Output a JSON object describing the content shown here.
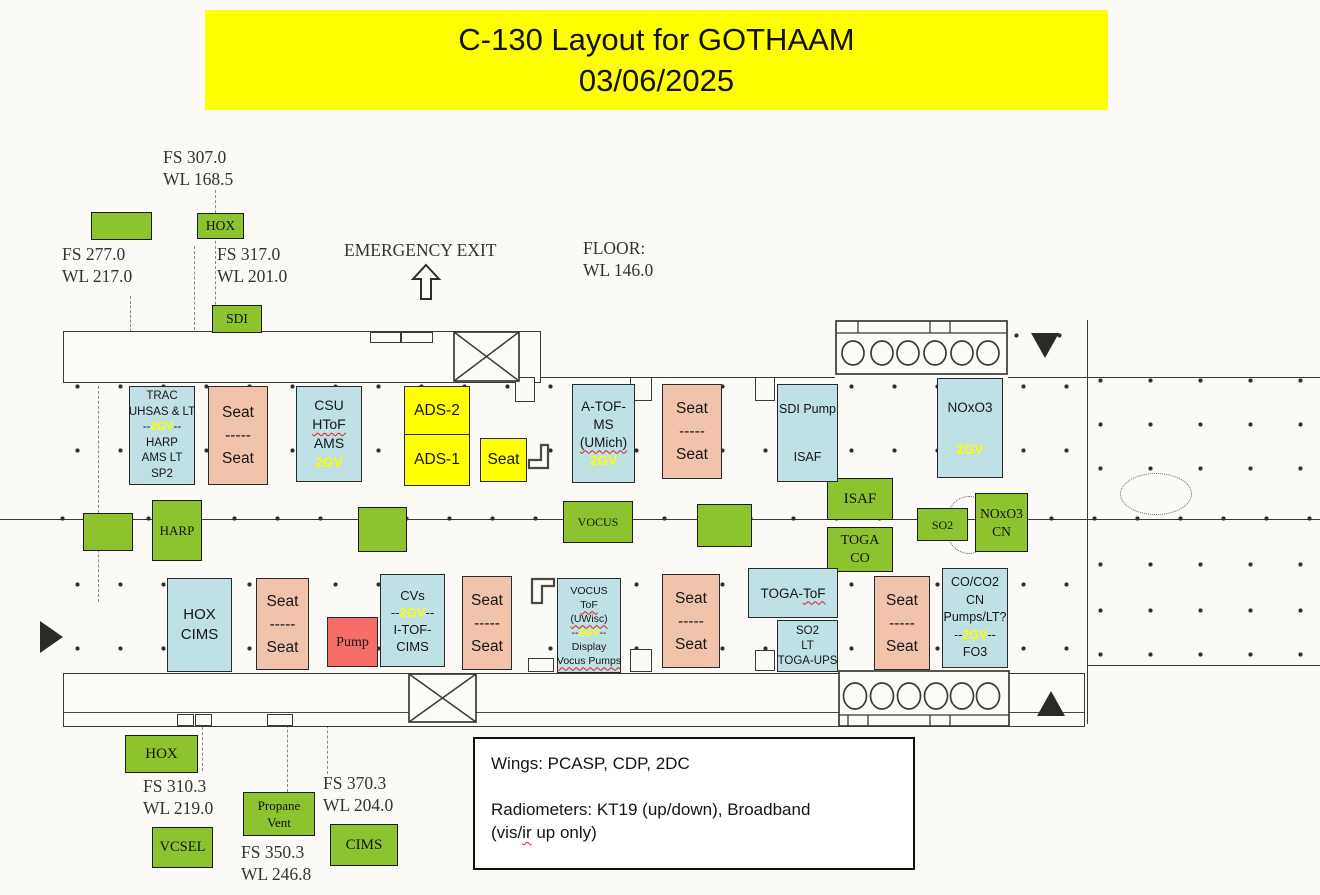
{
  "title": {
    "line1": "C-130 Layout for GOTHAAM",
    "line2": "03/06/2025"
  },
  "colors": {
    "banner_bg": "#ffff00",
    "green": "#8dc32e",
    "blue": "#bfe0e4",
    "salmon": "#f2c3ab",
    "yellow": "#ffff00",
    "red": "#f56d66",
    "accent_2gv": "#ffff00",
    "wavy_underline": "#e01b1b"
  },
  "station_labels": [
    {
      "name": "fs-307-label",
      "x": 163,
      "y": 146,
      "lines": [
        "FS 307.0",
        "WL 168.5"
      ]
    },
    {
      "name": "fs-277-label",
      "x": 62,
      "y": 243,
      "lines": [
        "FS 277.0",
        "WL 217.0"
      ]
    },
    {
      "name": "fs-317-label",
      "x": 217,
      "y": 243,
      "lines": [
        "FS 317.0",
        "WL 201.0"
      ]
    },
    {
      "name": "emergency-exit-label",
      "x": 344,
      "y": 239,
      "lines": [
        "EMERGENCY EXIT"
      ]
    },
    {
      "name": "floor-label",
      "x": 583,
      "y": 237,
      "lines": [
        "FLOOR:",
        "WL 146.0"
      ]
    },
    {
      "name": "fs-310-label",
      "x": 143,
      "y": 775,
      "lines": [
        "FS 310.3",
        "WL 219.0"
      ]
    },
    {
      "name": "fs-370-label",
      "x": 323,
      "y": 772,
      "lines": [
        "FS 370.3",
        "WL 204.0"
      ]
    },
    {
      "name": "fs-350-label",
      "x": 241,
      "y": 841,
      "lines": [
        "FS 350.3",
        "WL 246.8"
      ]
    }
  ],
  "green_boxes": [
    {
      "name": "green-box-unlabeled-top",
      "x": 91,
      "y": 212,
      "w": 61,
      "h": 28,
      "fs": 13,
      "lines": []
    },
    {
      "name": "hox-top-box",
      "x": 197,
      "y": 213,
      "w": 47,
      "h": 26,
      "fs": 13.5,
      "lines": [
        "HOX"
      ]
    },
    {
      "name": "sdi-box",
      "x": 212,
      "y": 305,
      "w": 50,
      "h": 28,
      "fs": 13.5,
      "lines": [
        "SDI"
      ]
    },
    {
      "name": "green-box-unlabeled-mid-left",
      "x": 83,
      "y": 513,
      "w": 50,
      "h": 38,
      "fs": 13,
      "lines": []
    },
    {
      "name": "harp-box",
      "x": 152,
      "y": 500,
      "w": 50,
      "h": 61,
      "fs": 13,
      "lines": [
        "HARP"
      ]
    },
    {
      "name": "green-box-unlabeled-mid-center",
      "x": 358,
      "y": 507,
      "w": 49,
      "h": 45,
      "fs": 13,
      "lines": []
    },
    {
      "name": "vocus-box",
      "x": 563,
      "y": 501,
      "w": 70,
      "h": 42,
      "fs": 12,
      "lines": [
        "VOCUS"
      ]
    },
    {
      "name": "green-box-unlabeled-mid-right",
      "x": 697,
      "y": 504,
      "w": 55,
      "h": 43,
      "fs": 13,
      "lines": []
    },
    {
      "name": "isaf-box",
      "x": 827,
      "y": 478,
      "w": 66,
      "h": 42,
      "fs": 15,
      "lines": [
        "ISAF"
      ]
    },
    {
      "name": "toga-co-box",
      "x": 827,
      "y": 527,
      "w": 66,
      "h": 45,
      "fs": 14,
      "lines": [
        "TOGA",
        "CO"
      ]
    },
    {
      "name": "so2-box",
      "x": 917,
      "y": 508,
      "w": 51,
      "h": 33,
      "fs": 12,
      "lines": [
        "SO2"
      ]
    },
    {
      "name": "noxo3-cn-box",
      "x": 975,
      "y": 493,
      "w": 53,
      "h": 59,
      "fs": 13.5,
      "lines": [
        "NOxO3",
        "CN"
      ]
    },
    {
      "name": "hox-bottom-box",
      "x": 125,
      "y": 735,
      "w": 73,
      "h": 38,
      "fs": 15,
      "lines": [
        "HOX"
      ]
    },
    {
      "name": "propane-vent-box",
      "x": 243,
      "y": 792,
      "w": 72,
      "h": 44,
      "fs": 13,
      "lines": [
        "Propane",
        "Vent"
      ]
    },
    {
      "name": "vcsel-box",
      "x": 152,
      "y": 827,
      "w": 61,
      "h": 41,
      "fs": 14.5,
      "lines": [
        "VCSEL"
      ]
    },
    {
      "name": "cims-box",
      "x": 330,
      "y": 824,
      "w": 68,
      "h": 42,
      "fs": 15,
      "lines": [
        "CIMS"
      ]
    }
  ],
  "instruments": [
    {
      "name": "trac-uhsas-rack",
      "type": "blue",
      "x": 129,
      "y": 386,
      "w": 66,
      "h": 99,
      "fs": 11.5,
      "lh": 15.5,
      "lines": [
        [
          {
            "t": "TRAC"
          }
        ],
        [
          {
            "t": "UHSAS & LT"
          }
        ],
        [
          {
            "t": "--"
          },
          {
            "t": "2GV",
            "y": 1
          },
          {
            "t": "--"
          }
        ],
        [
          {
            "t": "HARP"
          }
        ],
        [
          {
            "t": "AMS LT"
          }
        ],
        [
          {
            "t": "SP2"
          }
        ]
      ]
    },
    {
      "name": "seat-rack-1",
      "type": "salmon",
      "x": 208,
      "y": 386,
      "w": 60,
      "h": 99,
      "fs": 15.5,
      "lh": 23,
      "lines": [
        [
          {
            "t": "Seat"
          }
        ],
        [
          {
            "t": "-----"
          }
        ],
        [
          {
            "t": "Seat"
          }
        ]
      ]
    },
    {
      "name": "csu-htof-ams-rack",
      "type": "blue",
      "x": 296,
      "y": 386,
      "w": 66,
      "h": 96,
      "fs": 14,
      "lh": 19,
      "lines": [
        [
          {
            "t": "CSU"
          }
        ],
        [
          {
            "t": "HToF",
            "w": 1
          }
        ],
        [
          {
            "t": "AMS"
          }
        ],
        [
          {
            "t": "2GV",
            "y": 1
          }
        ]
      ]
    },
    {
      "name": "ads-2-box",
      "type": "yellow",
      "x": 404,
      "y": 386,
      "w": 66,
      "h": 49,
      "fs": 15.5,
      "lh": 18,
      "lines": [
        [
          {
            "t": "ADS-2"
          }
        ]
      ]
    },
    {
      "name": "ads-1-box",
      "type": "yellow",
      "x": 404,
      "y": 434,
      "w": 66,
      "h": 52,
      "fs": 15.5,
      "lh": 18,
      "lines": [
        [
          {
            "t": "ADS-1"
          }
        ]
      ]
    },
    {
      "name": "seat-yellow-box",
      "type": "yellow",
      "x": 480,
      "y": 438,
      "w": 47,
      "h": 44,
      "fs": 15.5,
      "lh": 18,
      "lines": [
        [
          {
            "t": "Seat"
          }
        ]
      ]
    },
    {
      "name": "a-tof-ms-rack",
      "type": "blue",
      "x": 572,
      "y": 384,
      "w": 63,
      "h": 99,
      "fs": 13.5,
      "lh": 18,
      "lines": [
        [
          {
            "t": "A-TOF-"
          }
        ],
        [
          {
            "t": "MS"
          }
        ],
        [
          {
            "t": "(UMich)",
            "w": 1
          }
        ],
        [
          {
            "t": "2GV",
            "y": 1
          }
        ]
      ]
    },
    {
      "name": "seat-rack-2",
      "type": "salmon",
      "x": 662,
      "y": 384,
      "w": 60,
      "h": 95,
      "fs": 15.5,
      "lh": 23,
      "lines": [
        [
          {
            "t": "Seat"
          }
        ],
        [
          {
            "t": "-----"
          }
        ],
        [
          {
            "t": "Seat"
          }
        ]
      ]
    },
    {
      "name": "sdi-pump-isaf-rack",
      "type": "blue",
      "x": 777,
      "y": 384,
      "w": 61,
      "h": 98,
      "fs": 12.5,
      "lh": 16,
      "lines": [
        [
          {
            "t": "SDI Pump"
          }
        ],
        [],
        [],
        [
          {
            "t": "ISAF"
          }
        ]
      ]
    },
    {
      "name": "noxo3-rack",
      "type": "blue",
      "x": 937,
      "y": 378,
      "w": 66,
      "h": 100,
      "fs": 13.5,
      "lh": 21,
      "lines": [
        [
          {
            "t": "NOxO3"
          }
        ],
        [],
        [
          {
            "t": "2GV",
            "y": 1
          }
        ]
      ]
    },
    {
      "name": "hox-cims-rack",
      "type": "blue",
      "x": 167,
      "y": 578,
      "w": 65,
      "h": 94,
      "fs": 15,
      "lh": 20,
      "lines": [
        [
          {
            "t": "HOX"
          }
        ],
        [
          {
            "t": "CIMS"
          }
        ]
      ]
    },
    {
      "name": "seat-rack-3",
      "type": "salmon",
      "x": 256,
      "y": 578,
      "w": 53,
      "h": 92,
      "fs": 15.5,
      "lh": 23,
      "lines": [
        [
          {
            "t": "Seat"
          }
        ],
        [
          {
            "t": "-----"
          }
        ],
        [
          {
            "t": "Seat"
          }
        ]
      ]
    },
    {
      "name": "pump-box",
      "type": "red",
      "x": 327,
      "y": 617,
      "w": 51,
      "h": 50,
      "fs": 14,
      "lh": 17,
      "lines": [
        [
          {
            "t": "Pump"
          }
        ]
      ]
    },
    {
      "name": "cvs-itof-cims-rack",
      "type": "blue",
      "x": 380,
      "y": 574,
      "w": 65,
      "h": 93,
      "fs": 13,
      "lh": 17,
      "lines": [
        [
          {
            "t": "CVs"
          }
        ],
        [
          {
            "t": "--"
          },
          {
            "t": "2GV",
            "y": 1
          },
          {
            "t": "--"
          }
        ],
        [
          {
            "t": "I-TOF-"
          }
        ],
        [
          {
            "t": "CIMS"
          }
        ]
      ]
    },
    {
      "name": "seat-rack-4",
      "type": "salmon",
      "x": 462,
      "y": 576,
      "w": 50,
      "h": 94,
      "fs": 15.5,
      "lh": 23,
      "lines": [
        [
          {
            "t": "Seat"
          }
        ],
        [
          {
            "t": "-----"
          }
        ],
        [
          {
            "t": "Seat"
          }
        ]
      ]
    },
    {
      "name": "vocus-tof-rack",
      "type": "blue",
      "x": 557,
      "y": 578,
      "w": 64,
      "h": 95,
      "fs": 10.5,
      "lh": 14,
      "lines": [
        [
          {
            "t": "VOCUS"
          }
        ],
        [
          {
            "t": "ToF",
            "w": 1
          }
        ],
        [
          {
            "t": "(UWisc)",
            "w": 1
          }
        ],
        [
          {
            "t": "--"
          },
          {
            "t": "2GV",
            "y": 1
          },
          {
            "t": "--"
          }
        ],
        [
          {
            "t": "Display"
          }
        ],
        [
          {
            "t": "Vocus Pumps",
            "w": 1
          }
        ]
      ]
    },
    {
      "name": "seat-rack-5",
      "type": "salmon",
      "x": 662,
      "y": 574,
      "w": 58,
      "h": 94,
      "fs": 15.5,
      "lh": 23,
      "lines": [
        [
          {
            "t": "Seat"
          }
        ],
        [
          {
            "t": "-----"
          }
        ],
        [
          {
            "t": "Seat"
          }
        ]
      ]
    },
    {
      "name": "toga-tof-rack",
      "type": "blue",
      "x": 748,
      "y": 568,
      "w": 90,
      "h": 50,
      "fs": 13.5,
      "lh": 17,
      "lines": [
        [
          {
            "t": "TOGA-"
          },
          {
            "t": "ToF",
            "w": 1
          }
        ]
      ]
    },
    {
      "name": "so2-lt-toga-ups-rack",
      "type": "blue",
      "x": 777,
      "y": 620,
      "w": 61,
      "h": 52,
      "fs": 11.5,
      "lh": 15,
      "lines": [
        [
          {
            "t": "SO2"
          }
        ],
        [
          {
            "t": "LT"
          }
        ],
        [
          {
            "t": "TOGA-UPS"
          }
        ]
      ]
    },
    {
      "name": "seat-rack-6",
      "type": "salmon",
      "x": 874,
      "y": 576,
      "w": 56,
      "h": 94,
      "fs": 15.5,
      "lh": 23,
      "lines": [
        [
          {
            "t": "Seat"
          }
        ],
        [
          {
            "t": "-----"
          }
        ],
        [
          {
            "t": "Seat"
          }
        ]
      ]
    },
    {
      "name": "co-co2-rack",
      "type": "blue",
      "x": 942,
      "y": 568,
      "w": 66,
      "h": 100,
      "fs": 12.5,
      "lh": 17.5,
      "lines": [
        [
          {
            "t": "CO/CO2"
          }
        ],
        [
          {
            "t": "CN"
          }
        ],
        [
          {
            "t": "Pumps/LT?"
          }
        ],
        [
          {
            "t": "--"
          },
          {
            "t": "2GV",
            "y": 1
          },
          {
            "t": "--"
          }
        ],
        [
          {
            "t": "FO3"
          }
        ]
      ]
    }
  ],
  "notes": {
    "lines": [
      [
        {
          "t": "Wings: PCASP, CDP, 2DC"
        }
      ],
      [],
      [
        {
          "t": "Radiometers: KT19 (up/down), Broadband"
        }
      ],
      [
        {
          "t": "(vis/"
        },
        {
          "t": "ir",
          "w": 1
        },
        {
          "t": " up only)"
        }
      ]
    ]
  }
}
